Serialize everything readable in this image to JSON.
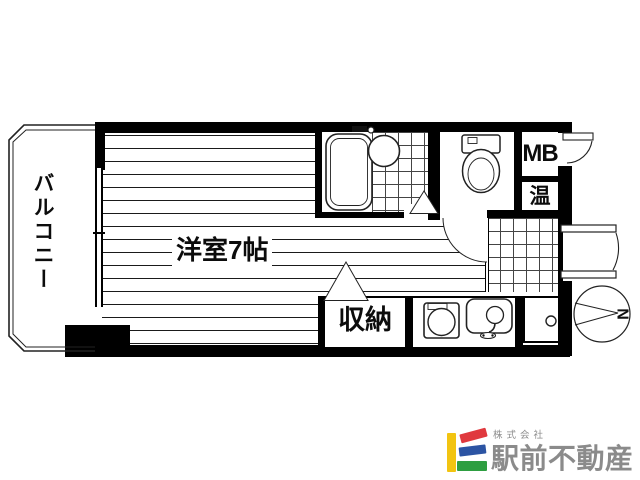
{
  "floorplan": {
    "labels": {
      "balcony": "バルコニー",
      "western_room": "洋室7帖",
      "storage": "収納",
      "meter_box": "MB",
      "water_heater": "温"
    },
    "compass": {
      "north": "N"
    }
  },
  "branding": {
    "company_prefix": "株式会社",
    "company_name": "駅前不動産",
    "text_color": "#8b8b8b",
    "logo_colors": {
      "yellow": "#F2C411",
      "red": "#E0393E",
      "blue": "#2C54A3",
      "green": "#2E9E41"
    }
  }
}
